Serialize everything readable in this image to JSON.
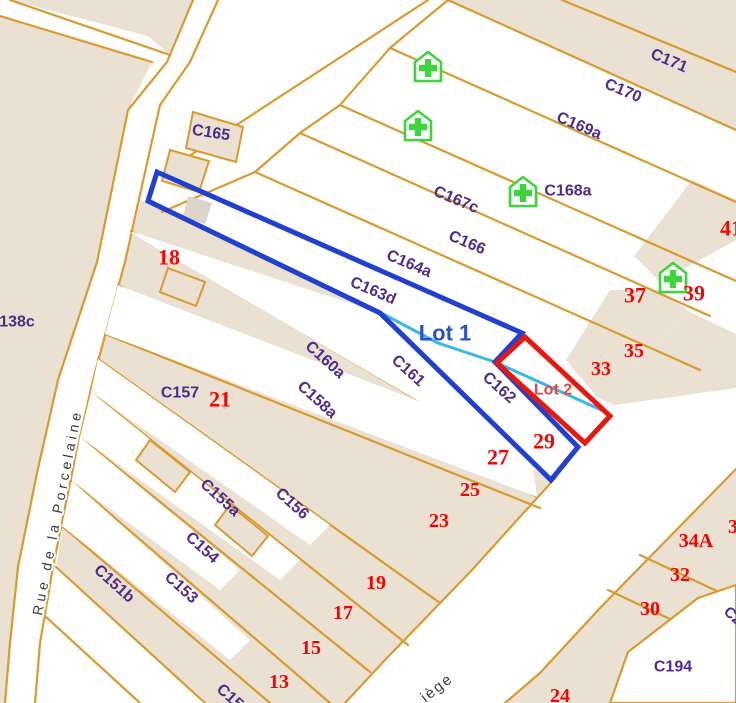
{
  "canvas": {
    "width": 736,
    "height": 703
  },
  "colors": {
    "background": "#ffffff",
    "parcel_fill": "#eae1d2",
    "building_gray": "#dcd5cb",
    "parcel_stroke": "#d99a2f",
    "label_purple": "#4f2a8f",
    "number_red": "#f00505",
    "lot1_blue": "#2040d0",
    "lot2_red": "#e81810",
    "measure_cyan": "#38b6e8",
    "pharmacy_green": "#3fd43f",
    "street_text": "#3c3c3c"
  },
  "map_features": {
    "beige_polygons": [
      {
        "name": "parcel-area-left-of-road",
        "points": "0,16 152,62 128,110 97,262 58,380 37,473 18,567 10,643 5,703 0,703"
      },
      {
        "name": "parcel-area-top-wedge",
        "points": "10,0 193,0 170,55 148,36"
      },
      {
        "name": "parcel-area-c171-strip",
        "points": "448,0 562,0 736,0 736,130"
      },
      {
        "name": "parcel-area-lower-fan",
        "points": "141,200 380,313 551,480 472,570 385,660 345,703 205,703 56,567 72,473 93,380 125,262"
      },
      {
        "name": "parcel-area-right-block-41",
        "points": "692,180 736,200 736,240 660,282 634,256"
      },
      {
        "name": "parcel-area-right-block-37-35",
        "points": "610,290 660,290 690,312 598,398 566,360"
      },
      {
        "name": "parcel-area-right-block-33",
        "points": "690,312 736,334 736,388 615,405 598,398"
      },
      {
        "name": "parcel-area-bottom-right-block",
        "points": "736,469 736,703 505,703 540,673 600,608"
      }
    ],
    "white_polygons": [
      {
        "name": "parcel-white-c161-strip",
        "points": "133,232 380,313 548,478 516,458 131,233"
      },
      {
        "name": "parcel-white-c162",
        "points": "440,335 575,440 410,365"
      },
      {
        "name": "parcel-white-c158a-strip",
        "points": "118,285 530,444 537,497 105,334"
      },
      {
        "name": "parcel-white-c156-strip",
        "points": "98,359 330,525 310,545 91,392"
      },
      {
        "name": "parcel-white-c155a-strip",
        "points": "91,392 300,560 280,580 80,437"
      },
      {
        "name": "parcel-white-c154-strip",
        "points": "80,437 240,570 220,590 72,481"
      },
      {
        "name": "parcel-white-c153-strip",
        "points": "72,481 250,640 230,660 62,526"
      },
      {
        "name": "parcel-white-c194-pocket",
        "points": "698,598 736,585 736,703 610,703 628,652",
        "stroked": true
      }
    ],
    "building_polygons": [
      {
        "name": "building-c165-a",
        "points": "193,112 243,127 236,162 186,148"
      },
      {
        "name": "building-c165-b",
        "points": "170,150 209,161 199,192 162,181"
      },
      {
        "name": "building-gray",
        "points": "188,196 212,203 205,224 183,217",
        "gray": true
      },
      {
        "name": "building-lot-tip",
        "points": "168,268 205,282 196,306 160,292"
      },
      {
        "name": "building-fan-a",
        "points": "150,440 190,472 175,492 136,460"
      },
      {
        "name": "building-fan-b",
        "points": "230,505 268,536 252,556 215,525"
      }
    ],
    "orange_lines": [
      {
        "name": "road-edge-left",
        "points": "193,0 167,62 128,110 97,262 58,380 37,473 18,567 10,643 5,703"
      },
      {
        "name": "road-edge-right",
        "points": "218,0 190,62 160,105 125,262 93,380 72,473 53,567 40,643 35,703"
      },
      {
        "name": "topleft-road-upper",
        "points": "10,0 170,55"
      },
      {
        "name": "topleft-road-lower",
        "points": "0,16 152,62"
      },
      {
        "name": "strip-b1",
        "points": "562,0 736,72"
      },
      {
        "name": "strip-b2",
        "points": "448,0 736,130"
      },
      {
        "name": "strip-b3",
        "points": "390,48 736,202"
      },
      {
        "name": "strip-b4",
        "points": "340,105 736,281"
      },
      {
        "name": "strip-b5",
        "points": "300,133 710,316"
      },
      {
        "name": "strip-b6",
        "points": "255,172 700,370"
      },
      {
        "name": "strip-cap",
        "points": "448,0 390,48 340,105 300,133 255,172 162,212"
      },
      {
        "name": "access-band-edge",
        "points": "428,0 160,175"
      },
      {
        "name": "fan-u2",
        "points": "131,231 516,458"
      },
      {
        "name": "fan-u3",
        "points": "118,285 537,497"
      },
      {
        "name": "fan-u4",
        "points": "105,334 540,508"
      },
      {
        "name": "fan-u5",
        "points": "98,359 440,603"
      },
      {
        "name": "fan-u6",
        "points": "91,392 408,645"
      },
      {
        "name": "fan-u7",
        "points": "80,437 370,672"
      },
      {
        "name": "fan-u8",
        "points": "72,481 330,703"
      },
      {
        "name": "fan-u9",
        "points": "62,526 270,703"
      },
      {
        "name": "fan-u10",
        "points": "56,567 205,703"
      },
      {
        "name": "fan-u11",
        "points": "46,617 140,703"
      },
      {
        "name": "fan-tail-parcel-line",
        "points": "380,313 551,480"
      },
      {
        "name": "street-upper-edge",
        "points": "556,477 472,570 385,660 345,703"
      },
      {
        "name": "street-lower-edge",
        "points": "736,469 600,608 540,673 505,703"
      },
      {
        "name": "divider-34a-32",
        "points": "640,555 736,600"
      },
      {
        "name": "divider-32-30",
        "points": "608,590 736,650"
      }
    ],
    "overlays": {
      "lot1": {
        "label": "Lot 1",
        "points": "157,172 522,333 495,362 578,447 551,480 380,313 148,201",
        "color": "#2040d0",
        "width": 5
      },
      "lot2": {
        "label": "Lot 2",
        "points": "525,337 610,416 585,443 497,363",
        "color": "#e81810",
        "width": 5
      },
      "measure_line": {
        "points": "370,307 438,343 495,362 608,413",
        "color": "#38b6e8",
        "width": 3
      }
    },
    "pharmacy_icons": [
      {
        "x": 428,
        "y": 68
      },
      {
        "x": 418,
        "y": 127
      },
      {
        "x": 523,
        "y": 193
      },
      {
        "x": 673,
        "y": 279
      }
    ],
    "labels": [
      {
        "text": "C165",
        "x": 211,
        "y": 133,
        "rot": 9,
        "cls": "lbl-parcel"
      },
      {
        "text": "138c",
        "x": 17,
        "y": 322,
        "rot": 0,
        "cls": "lbl-parcel"
      },
      {
        "text": "C167c",
        "x": 456,
        "y": 200,
        "rot": 23,
        "cls": "lbl-parcel"
      },
      {
        "text": "C166",
        "x": 467,
        "y": 243,
        "rot": 23,
        "cls": "lbl-parcel"
      },
      {
        "text": "C164a",
        "x": 409,
        "y": 264,
        "rot": 23,
        "cls": "lbl-parcel"
      },
      {
        "text": "C163d",
        "x": 373,
        "y": 291,
        "rot": 23,
        "cls": "lbl-parcel"
      },
      {
        "text": "C169a",
        "x": 579,
        "y": 126,
        "rot": 23,
        "cls": "lbl-parcel"
      },
      {
        "text": "C170",
        "x": 623,
        "y": 91,
        "rot": 23,
        "cls": "lbl-parcel"
      },
      {
        "text": "C171",
        "x": 669,
        "y": 61,
        "rot": 23,
        "cls": "lbl-parcel"
      },
      {
        "text": "C168a",
        "x": 568,
        "y": 191,
        "rot": 0,
        "cls": "lbl-parcel"
      },
      {
        "text": "C161",
        "x": 408,
        "y": 371,
        "rot": 42,
        "cls": "lbl-parcel"
      },
      {
        "text": "C162",
        "x": 499,
        "y": 388,
        "rot": 42,
        "cls": "lbl-parcel"
      },
      {
        "text": "C160a",
        "x": 325,
        "y": 360,
        "rot": 42,
        "cls": "lbl-parcel"
      },
      {
        "text": "C158a",
        "x": 317,
        "y": 400,
        "rot": 42,
        "cls": "lbl-parcel"
      },
      {
        "text": "C157",
        "x": 180,
        "y": 393,
        "rot": 0,
        "cls": "lbl-parcel"
      },
      {
        "text": "C156",
        "x": 292,
        "y": 504,
        "rot": 42,
        "cls": "lbl-parcel"
      },
      {
        "text": "C155a",
        "x": 220,
        "y": 498,
        "rot": 42,
        "cls": "lbl-parcel"
      },
      {
        "text": "C154",
        "x": 202,
        "y": 548,
        "rot": 42,
        "cls": "lbl-parcel"
      },
      {
        "text": "C153",
        "x": 181,
        "y": 588,
        "rot": 42,
        "cls": "lbl-parcel"
      },
      {
        "text": "C151b",
        "x": 114,
        "y": 584,
        "rot": 42,
        "cls": "lbl-parcel"
      },
      {
        "text": "C152",
        "x": 233,
        "y": 700,
        "rot": 42,
        "cls": "lbl-parcel"
      },
      {
        "text": "C194",
        "x": 673,
        "y": 667,
        "rot": 0,
        "cls": "lbl-parcel"
      },
      {
        "text": "C2",
        "x": 733,
        "y": 616,
        "rot": 42,
        "cls": "lbl-parcel-sm"
      },
      {
        "text": "18",
        "x": 169,
        "y": 257,
        "rot": 0,
        "cls": "lbl-num"
      },
      {
        "text": "21",
        "x": 220,
        "y": 399,
        "rot": 0,
        "cls": "lbl-num"
      },
      {
        "text": "37",
        "x": 635,
        "y": 295,
        "rot": 0,
        "cls": "lbl-num"
      },
      {
        "text": "39",
        "x": 694,
        "y": 293,
        "rot": 0,
        "cls": "lbl-num"
      },
      {
        "text": "41",
        "x": 731,
        "y": 228,
        "rot": 0,
        "cls": "lbl-num"
      },
      {
        "text": "35",
        "x": 634,
        "y": 351,
        "rot": 0,
        "cls": "lbl-num-sm"
      },
      {
        "text": "33",
        "x": 601,
        "y": 369,
        "rot": 0,
        "cls": "lbl-num-sm"
      },
      {
        "text": "29",
        "x": 544,
        "y": 441,
        "rot": 0,
        "cls": "lbl-num"
      },
      {
        "text": "27",
        "x": 498,
        "y": 457,
        "rot": 0,
        "cls": "lbl-num"
      },
      {
        "text": "25",
        "x": 470,
        "y": 490,
        "rot": 0,
        "cls": "lbl-num-sm"
      },
      {
        "text": "23",
        "x": 439,
        "y": 521,
        "rot": 0,
        "cls": "lbl-num-sm"
      },
      {
        "text": "19",
        "x": 376,
        "y": 583,
        "rot": 0,
        "cls": "lbl-num-sm"
      },
      {
        "text": "17",
        "x": 343,
        "y": 613,
        "rot": 0,
        "cls": "lbl-num-sm"
      },
      {
        "text": "15",
        "x": 311,
        "y": 648,
        "rot": 0,
        "cls": "lbl-num-sm"
      },
      {
        "text": "13",
        "x": 279,
        "y": 682,
        "rot": 0,
        "cls": "lbl-num-sm"
      },
      {
        "text": "34A",
        "x": 696,
        "y": 541,
        "rot": 0,
        "cls": "lbl-num-sm"
      },
      {
        "text": "3",
        "x": 733,
        "y": 527,
        "rot": 0,
        "cls": "lbl-num-sm"
      },
      {
        "text": "32",
        "x": 680,
        "y": 575,
        "rot": 0,
        "cls": "lbl-num-sm"
      },
      {
        "text": "30",
        "x": 650,
        "y": 609,
        "rot": 0,
        "cls": "lbl-num-sm"
      },
      {
        "text": "24",
        "x": 560,
        "y": 696,
        "rot": 0,
        "cls": "lbl-num-sm"
      },
      {
        "text": "Rue de la Porcelaine",
        "x": 57,
        "y": 512,
        "rot": -79,
        "cls": "lbl-street"
      },
      {
        "text": "iège",
        "x": 437,
        "y": 688,
        "rot": -38,
        "cls": "lbl-street2"
      },
      {
        "text": "Lot 1",
        "x": 445,
        "y": 333,
        "rot": 0,
        "cls": "lbl-lot1"
      },
      {
        "text": "Lot 2",
        "x": 553,
        "y": 390,
        "rot": 0,
        "cls": "lbl-lot2"
      }
    ]
  }
}
